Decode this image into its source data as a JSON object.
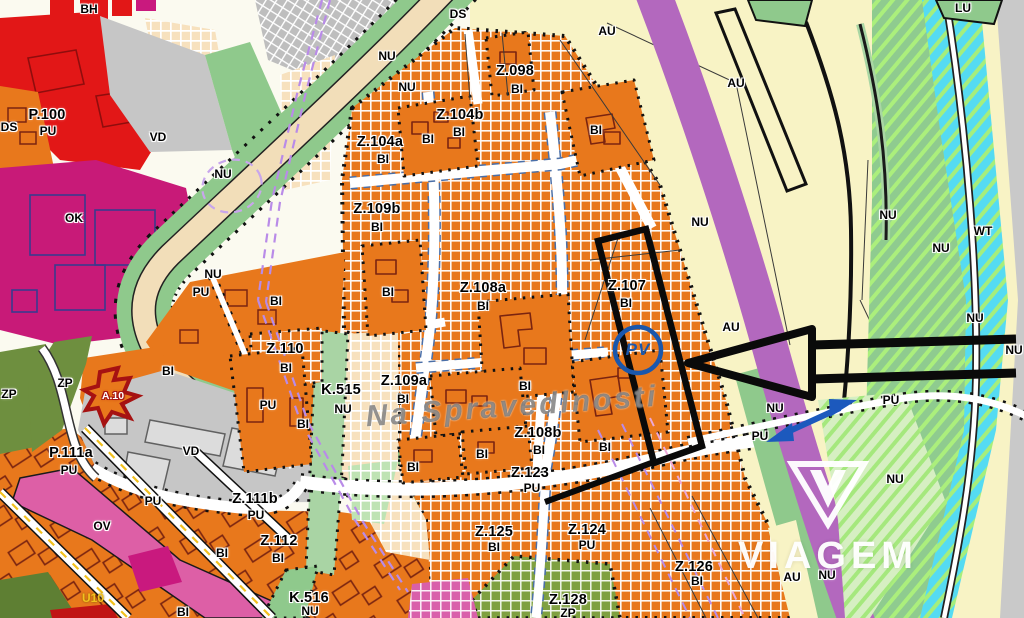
{
  "map": {
    "title": "zoning plan view",
    "watermark": {
      "text": "VIAGEM"
    },
    "street": {
      "text": "Na Spravedlnosti"
    },
    "marker": {
      "text": "PV"
    },
    "colors": {
      "zone_orange": "#E8781C",
      "au_yellow": "#F8F3C5",
      "ok_magenta": "#C81A78",
      "ov_pink": "#DD5FA6",
      "bh_red": "#E21717",
      "vd_gray": "#C6C6C6",
      "nu_green": "#8FC98C",
      "zp_olive": "#6E8F3F",
      "wt_cyan": "#55DBF2",
      "road_purple": "#B368BE",
      "road_beige": "#F2DEB9",
      "marker_blue": "#1A57AC",
      "highlight_arrow_black": "#0A0A0A",
      "direction_arrow_blue": "#1C59BD",
      "street_dash_yellow": "#F2C11E"
    },
    "labels": [
      {
        "t": "BH",
        "x": 89,
        "y": 9,
        "k": "use"
      },
      {
        "t": "P.100",
        "x": 47,
        "y": 115,
        "k": "zone"
      },
      {
        "t": "PU",
        "x": 48,
        "y": 131,
        "k": "use"
      },
      {
        "t": "DS",
        "x": 9,
        "y": 127,
        "k": "use"
      },
      {
        "t": "VD",
        "x": 158,
        "y": 137,
        "k": "use"
      },
      {
        "t": "OK",
        "x": 74,
        "y": 218,
        "k": "use"
      },
      {
        "t": "NU",
        "x": 223,
        "y": 174,
        "k": "use"
      },
      {
        "t": "DS",
        "x": 458,
        "y": 14,
        "k": "use"
      },
      {
        "t": "NU",
        "x": 387,
        "y": 56,
        "k": "use"
      },
      {
        "t": "NU",
        "x": 407,
        "y": 87,
        "k": "use"
      },
      {
        "t": "AU",
        "x": 607,
        "y": 31,
        "k": "use"
      },
      {
        "t": "AU",
        "x": 736,
        "y": 83,
        "k": "use"
      },
      {
        "t": "LU",
        "x": 963,
        "y": 8,
        "k": "use"
      },
      {
        "t": "Z.098",
        "x": 515,
        "y": 71,
        "k": "zone"
      },
      {
        "t": "BI",
        "x": 517,
        "y": 89,
        "k": "use"
      },
      {
        "t": "BI",
        "x": 596,
        "y": 130,
        "k": "use"
      },
      {
        "t": "Z.104b",
        "x": 460,
        "y": 115,
        "k": "zone"
      },
      {
        "t": "BI",
        "x": 459,
        "y": 132,
        "k": "use"
      },
      {
        "t": "BI",
        "x": 428,
        "y": 139,
        "k": "use"
      },
      {
        "t": "Z.104a",
        "x": 380,
        "y": 142,
        "k": "zone"
      },
      {
        "t": "BI",
        "x": 383,
        "y": 159,
        "k": "use"
      },
      {
        "t": "Z.109b",
        "x": 377,
        "y": 209,
        "k": "zone"
      },
      {
        "t": "BI",
        "x": 377,
        "y": 227,
        "k": "use"
      },
      {
        "t": "NU",
        "x": 213,
        "y": 274,
        "k": "use"
      },
      {
        "t": "PU",
        "x": 201,
        "y": 292,
        "k": "use"
      },
      {
        "t": "BI",
        "x": 276,
        "y": 301,
        "k": "use"
      },
      {
        "t": "BI",
        "x": 388,
        "y": 292,
        "k": "use"
      },
      {
        "t": "Z.108a",
        "x": 483,
        "y": 288,
        "k": "zone"
      },
      {
        "t": "BI",
        "x": 483,
        "y": 306,
        "k": "use"
      },
      {
        "t": "Z.107",
        "x": 627,
        "y": 286,
        "k": "zone"
      },
      {
        "t": "BI",
        "x": 626,
        "y": 303,
        "k": "use"
      },
      {
        "t": "NU",
        "x": 700,
        "y": 222,
        "k": "use"
      },
      {
        "t": "AU",
        "x": 731,
        "y": 327,
        "k": "use"
      },
      {
        "t": "NU",
        "x": 888,
        "y": 215,
        "k": "use"
      },
      {
        "t": "WT",
        "x": 983,
        "y": 231,
        "k": "use"
      },
      {
        "t": "NU",
        "x": 941,
        "y": 248,
        "k": "use"
      },
      {
        "t": "NU",
        "x": 975,
        "y": 318,
        "k": "use"
      },
      {
        "t": "NU",
        "x": 1014,
        "y": 350,
        "k": "use"
      },
      {
        "t": "Z.110",
        "x": 285,
        "y": 349,
        "k": "zone"
      },
      {
        "t": "BI",
        "x": 286,
        "y": 368,
        "k": "use"
      },
      {
        "t": "BI",
        "x": 168,
        "y": 371,
        "k": "use"
      },
      {
        "t": "ZP",
        "x": 9,
        "y": 394,
        "k": "use"
      },
      {
        "t": "ZP",
        "x": 65,
        "y": 383,
        "k": "use"
      },
      {
        "t": "A.10",
        "x": 113,
        "y": 396,
        "k": "a10"
      },
      {
        "t": "K.515",
        "x": 341,
        "y": 390,
        "k": "zone"
      },
      {
        "t": "NU",
        "x": 343,
        "y": 409,
        "k": "use"
      },
      {
        "t": "PU",
        "x": 268,
        "y": 405,
        "k": "use"
      },
      {
        "t": "BI",
        "x": 303,
        "y": 424,
        "k": "use"
      },
      {
        "t": "Z.109a",
        "x": 404,
        "y": 381,
        "k": "zone"
      },
      {
        "t": "BI",
        "x": 403,
        "y": 399,
        "k": "use"
      },
      {
        "t": "BI",
        "x": 525,
        "y": 386,
        "k": "use"
      },
      {
        "t": "Z.108b",
        "x": 538,
        "y": 433,
        "k": "zone"
      },
      {
        "t": "BI",
        "x": 539,
        "y": 450,
        "k": "use"
      },
      {
        "t": "BI",
        "x": 605,
        "y": 447,
        "k": "use"
      },
      {
        "t": "BI",
        "x": 413,
        "y": 467,
        "k": "use"
      },
      {
        "t": "BI",
        "x": 482,
        "y": 454,
        "k": "use"
      },
      {
        "t": "P.111a",
        "x": 71,
        "y": 453,
        "k": "zone"
      },
      {
        "t": "PU",
        "x": 69,
        "y": 470,
        "k": "use"
      },
      {
        "t": "VD",
        "x": 191,
        "y": 451,
        "k": "use"
      },
      {
        "t": "PU",
        "x": 153,
        "y": 501,
        "k": "use"
      },
      {
        "t": "OV",
        "x": 102,
        "y": 526,
        "k": "use"
      },
      {
        "t": "Z.111b",
        "x": 255,
        "y": 499,
        "k": "zone"
      },
      {
        "t": "PU",
        "x": 256,
        "y": 515,
        "k": "use"
      },
      {
        "t": "Z.123",
        "x": 530,
        "y": 473,
        "k": "zone"
      },
      {
        "t": "PU",
        "x": 532,
        "y": 488,
        "k": "use"
      },
      {
        "t": "NU",
        "x": 775,
        "y": 408,
        "k": "use"
      },
      {
        "t": "PU",
        "x": 760,
        "y": 436,
        "k": "use"
      },
      {
        "t": "PU",
        "x": 891,
        "y": 400,
        "k": "use"
      },
      {
        "t": "Z.112",
        "x": 279,
        "y": 541,
        "k": "zone"
      },
      {
        "t": "BI",
        "x": 278,
        "y": 558,
        "k": "use"
      },
      {
        "t": "BI",
        "x": 222,
        "y": 553,
        "k": "use"
      },
      {
        "t": "Z.125",
        "x": 494,
        "y": 532,
        "k": "zone"
      },
      {
        "t": "BI",
        "x": 494,
        "y": 547,
        "k": "use"
      },
      {
        "t": "Z.124",
        "x": 587,
        "y": 530,
        "k": "zone"
      },
      {
        "t": "PU",
        "x": 587,
        "y": 545,
        "k": "use"
      },
      {
        "t": "Z.126",
        "x": 694,
        "y": 567,
        "k": "zone"
      },
      {
        "t": "BI",
        "x": 697,
        "y": 581,
        "k": "use"
      },
      {
        "t": "Z.128",
        "x": 568,
        "y": 600,
        "k": "zone"
      },
      {
        "t": "ZP",
        "x": 568,
        "y": 613,
        "k": "use"
      },
      {
        "t": "K.516",
        "x": 309,
        "y": 598,
        "k": "zone"
      },
      {
        "t": "NU",
        "x": 310,
        "y": 611,
        "k": "use"
      },
      {
        "t": "BI",
        "x": 183,
        "y": 612,
        "k": "use"
      },
      {
        "t": "U10",
        "x": 93,
        "y": 598,
        "k": "u10"
      },
      {
        "t": "NU",
        "x": 895,
        "y": 479,
        "k": "use"
      },
      {
        "t": "AU",
        "x": 792,
        "y": 577,
        "k": "use"
      },
      {
        "t": "NU",
        "x": 827,
        "y": 575,
        "k": "use"
      },
      {
        "t": "Na Spravedlnosti",
        "x": 512,
        "y": 407,
        "k": "street"
      },
      {
        "t": "PV",
        "x": 638,
        "y": 350,
        "k": "marker"
      }
    ]
  }
}
